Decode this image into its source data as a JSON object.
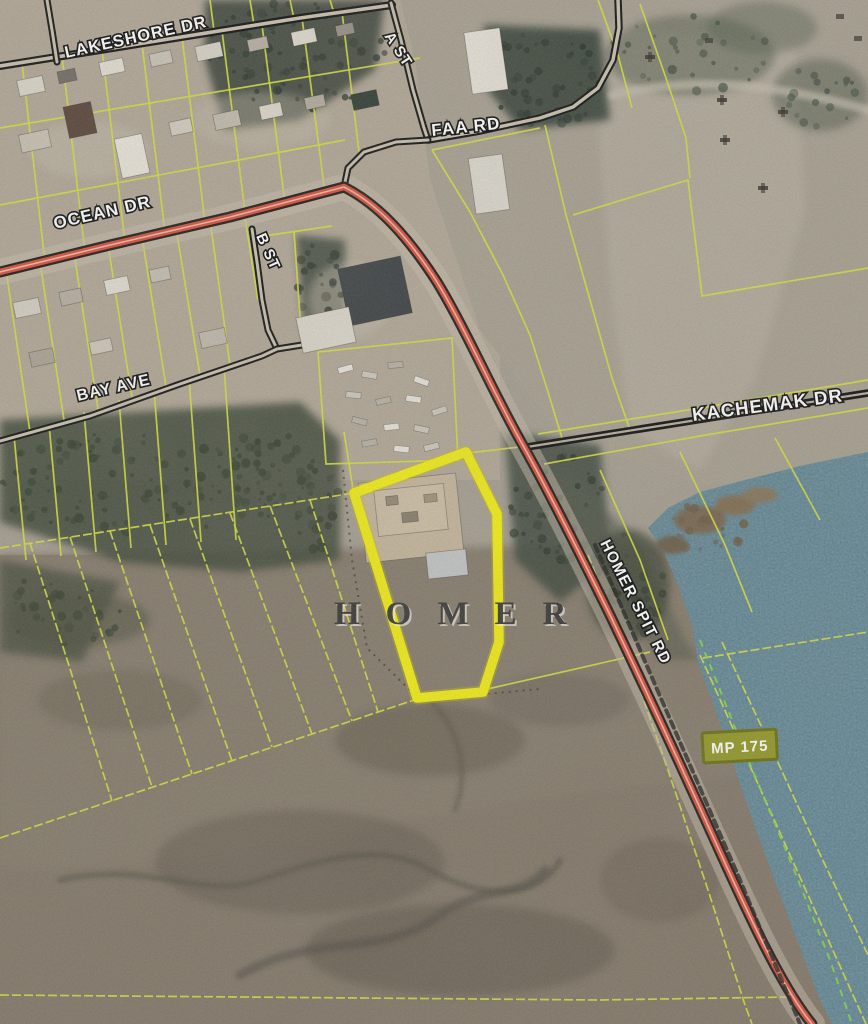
{
  "map": {
    "place_label": "HOMER",
    "milepost_badge": "MP 175",
    "road_labels": {
      "lakeshore": "LAKESHORE DR",
      "a_st": "A ST",
      "faa": "FAA RD",
      "ocean": "OCEAN DR",
      "b_st": "B ST",
      "bay": "BAY AVE",
      "kachemak": "KACHEMAK DR",
      "homer_spit": "HOMER SPIT RD"
    },
    "colors": {
      "parcel_line": "#d7e045",
      "highlight_parcel_outline": "#f2ee1c",
      "highlighted_road": "#dc5340",
      "water": "#597f8e",
      "milepost_fill": "#979b2d",
      "road_label_text": "#ffffff",
      "place_label_text": "#3f3e3c"
    }
  }
}
